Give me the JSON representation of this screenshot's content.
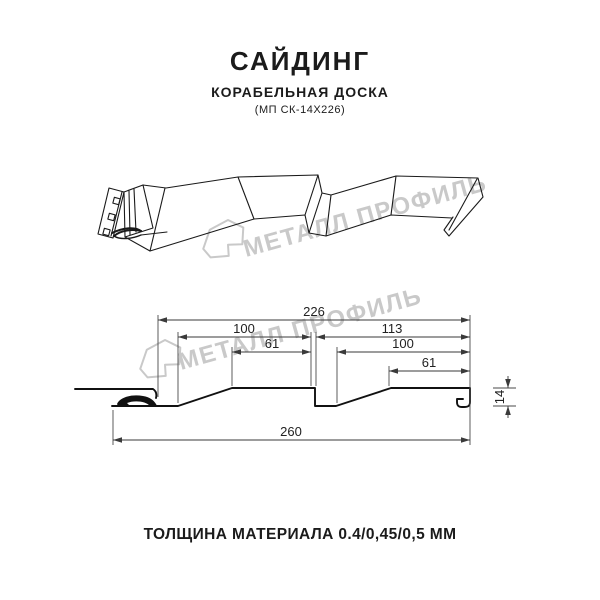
{
  "header": {
    "title": "САЙДИНГ",
    "subtitle": "КОРАБЕЛЬНАЯ ДОСКА",
    "model": "(МП СК-14Х226)"
  },
  "watermark": {
    "brand": "МЕТАЛЛ ПРОФИЛЬ",
    "color": "#c9c9c9"
  },
  "section_dimensions": {
    "coverage_width": "226",
    "left_board_width": "100",
    "right_board_width": "113",
    "left_board_flat": "61",
    "right_board_inner": "100",
    "right_board_flat": "61",
    "profile_height": "14",
    "overall_width": "260"
  },
  "footer": {
    "thickness_label": "ТОЛЩИНА МАТЕРИАЛА 0.4/0,45/0,5 ММ"
  },
  "colors": {
    "line": "#1a1a1a",
    "dimension_line": "#3a3a3a",
    "watermark": "#c9c9c9"
  }
}
